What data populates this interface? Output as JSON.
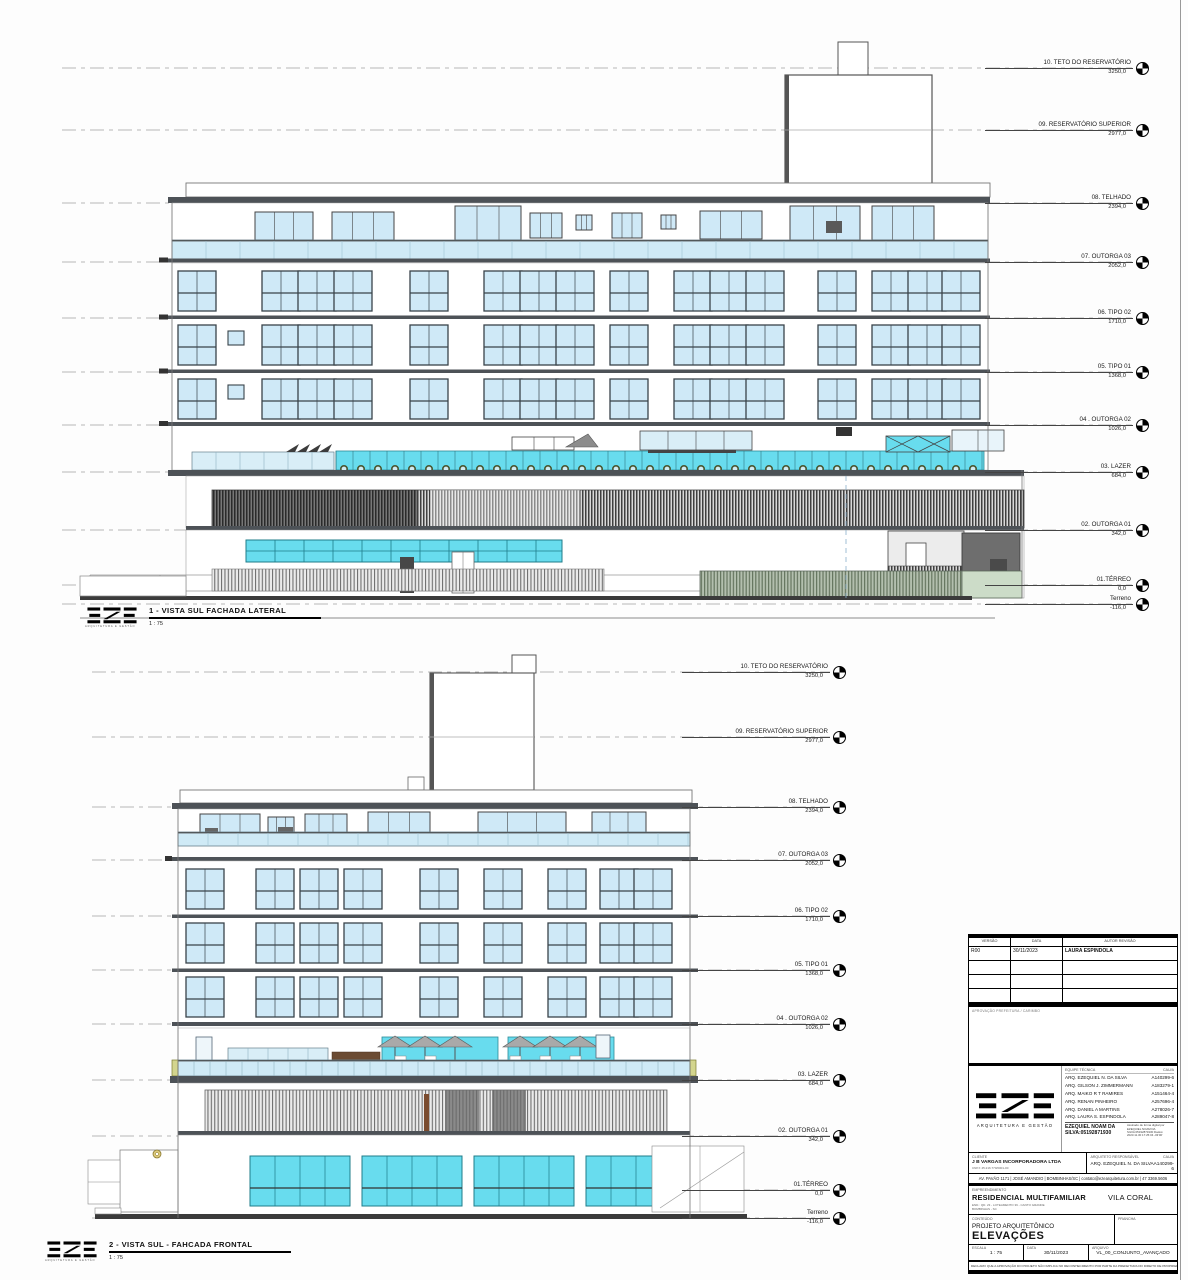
{
  "levels": [
    {
      "label": "10. TETO DO RESERVATÓRIO",
      "value": "3250,0"
    },
    {
      "label": "09. RESERVATÓRIO SUPERIOR",
      "value": "2977,0"
    },
    {
      "label": "08. TELHADO",
      "value": "2394,0"
    },
    {
      "label": "07. OUTORGA 03",
      "value": "2052,0"
    },
    {
      "label": "06. TIPO 02",
      "value": "1710,0"
    },
    {
      "label": "05. TIPO 01",
      "value": "1368,0"
    },
    {
      "label": "04 . OUTORGA 02",
      "value": "1026,0"
    },
    {
      "label": "03. LAZER",
      "value": "684,0"
    },
    {
      "label": "02. OUTORGA 01",
      "value": "342,0"
    },
    {
      "label": "01.TÉRREO",
      "value": "0,0"
    },
    {
      "label": "Terreno",
      "value": "-116,0"
    }
  ],
  "drawings": [
    {
      "title": "1 - VISTA SUL FACHADA LATERAL",
      "scale": "1 : 75"
    },
    {
      "title": "2 - VISTA SUL - FAHCADA FRONTAL",
      "scale": "1 : 75"
    }
  ],
  "logo": {
    "name": "EZE",
    "tagline": "ARQUITETURA E GESTÃO"
  },
  "colors": {
    "glass_light": "#cfe9f7",
    "glass_cyan": "#68dcee",
    "balustrade": "#cfeaf6",
    "slab": "#4d5257"
  },
  "titleblock": {
    "revisions": {
      "headers": [
        "VERSÃO",
        "DATA",
        "AUTOR REVISÃO"
      ],
      "rows": [
        [
          "R00",
          "30/11/2023",
          "LAURA ESPINDOLA"
        ],
        [
          "",
          "",
          ""
        ],
        [
          "",
          "",
          ""
        ],
        [
          "",
          "",
          ""
        ]
      ]
    },
    "approval_label": "APROVAÇÃO PREFEITURA / CARIMBO",
    "team": {
      "col1": "EQUIPE TÉCNICA",
      "col2": "CAU/A",
      "members": [
        [
          "ARQ. EZEQUIEL N. DA SILVA",
          "A140299-6"
        ],
        [
          "ARQ. GILSON J. ZIMMERMANN",
          "A183279-1"
        ],
        [
          "ARQ. MAIKO R T RAMIRES",
          "A151464-4"
        ],
        [
          "ARQ. RENAN PINHEIRO",
          "A257696-4"
        ],
        [
          "ARQ. DANIEL A MARTINS",
          "A278026-7"
        ],
        [
          "ARQ. LAURA S. ESPINDOLA",
          "A289047-8"
        ]
      ]
    },
    "signature": {
      "name": "EZEQUIEL NOAM DA SILVA:05192871930",
      "meta": "Assinado de forma digital por EZEQUIEL NOAM DA SILVA:05192871930 Dados: 2023.11.30 17:25:04 -03'00'"
    },
    "client": {
      "label": "CLIENTE",
      "name": "J B VARGAS INCORPORADORA LTDA",
      "sub": "CNPJ: 45.216.770/0001-00"
    },
    "responsible": {
      "label": "ARQUITETO RESPONSÁVEL",
      "name": "ARQ. EZEQUIEL N. DA SILVA",
      "cau_label": "CAU/A",
      "cau": "A140299-6"
    },
    "address": "AV. PAVÃO 1171 | JOSÉ AMANDIO | BOMBINHAS/SC | contato@ezearquitetura.com.br | 47 3369.5606",
    "project": {
      "label": "EMPREENDIMENTO",
      "name": "RESIDENCIAL MULTIFAMILIAR",
      "name2": "VILA CORAL",
      "end1": "END.: QD. 23 - LOTEAMENTO 39 - CANTO GRANDE",
      "end2": "BOMBINHAS - SC"
    },
    "content": {
      "label": "CONTEÚDO",
      "line1": "PROJETO ARQUITETÔNICO",
      "line2": "ELEVAÇÕES",
      "sheet_label": "PRANCHA",
      "sheet_value": ""
    },
    "meta": {
      "scale_label": "ESCALA",
      "scale": "1 : 75",
      "date_label": "DATA",
      "date": "30/11/2023",
      "file_label": "ARQUIVO",
      "file": "VL_00_CONJUNTO_AVANÇADO"
    },
    "disclaimer": "DECLARO QUE A APROVAÇÃO DO PROJETO NÃO IMPLICA NO RECONHECIMENTO POR PARTE DA PREFEITURA DO DIREITO DE PROPRIEDADE DO TERRENO"
  }
}
